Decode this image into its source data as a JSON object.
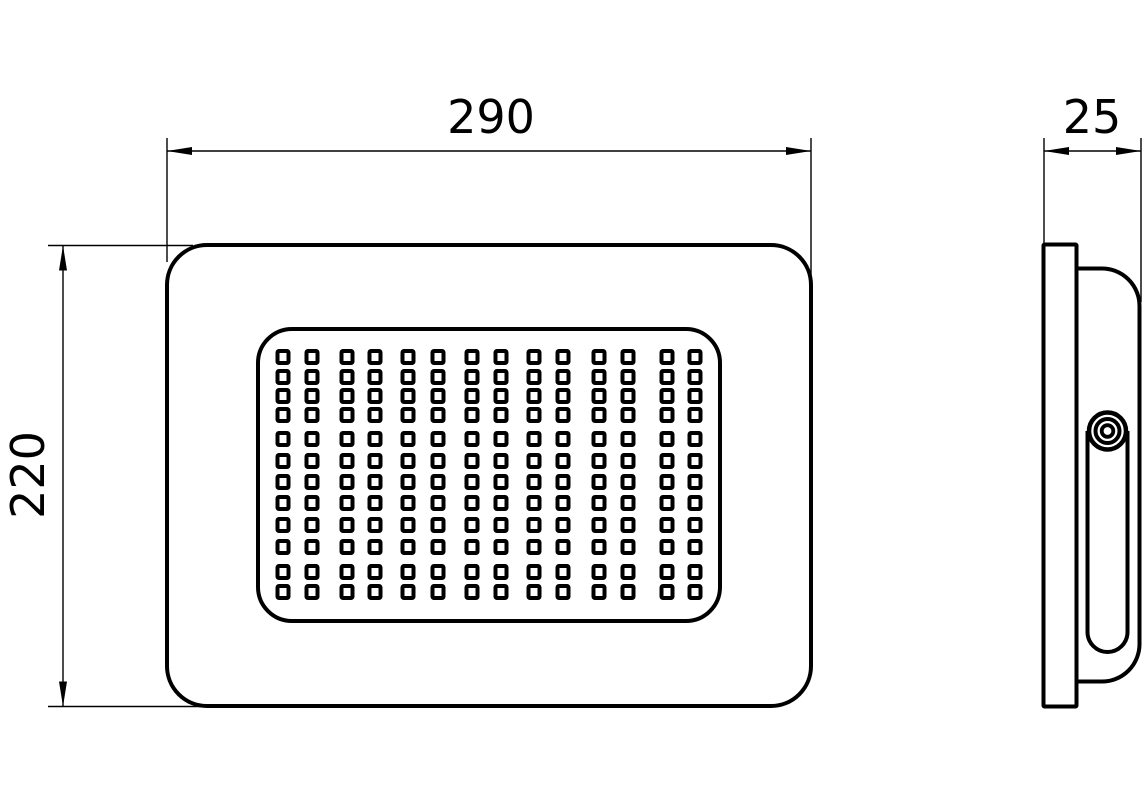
{
  "drawing": {
    "colors": {
      "line": "#000000",
      "background": "#ffffff"
    },
    "dimensions": {
      "width": {
        "label": "290"
      },
      "height": {
        "label": "220"
      },
      "depth": {
        "label": "25"
      }
    },
    "led_grid": {
      "columns": [
        283,
        312,
        347,
        375,
        408,
        438,
        472,
        501,
        534,
        563,
        599,
        628,
        667,
        695
      ],
      "rows": [
        357,
        377,
        396,
        415,
        439,
        461,
        482,
        503,
        525,
        547,
        572,
        592
      ],
      "led_outer_width": 15,
      "led_outer_height": 16,
      "led_count": 168
    }
  }
}
